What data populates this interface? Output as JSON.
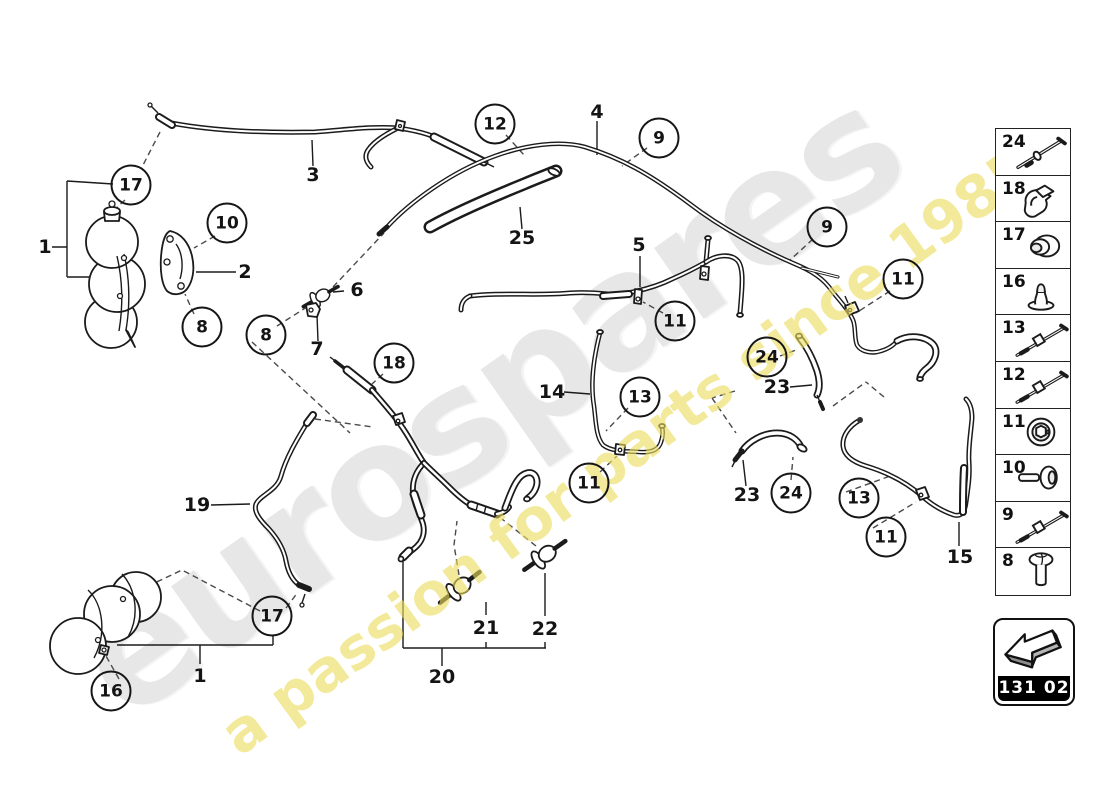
{
  "watermark": {
    "brand": "eurospares",
    "tagline": "a passion for parts since 1985",
    "brand_color": "#e7e7e7",
    "tagline_color": "#ecdc5c"
  },
  "diagram": {
    "callouts": [
      {
        "label": "1",
        "x": 45,
        "y": 247,
        "circled": false
      },
      {
        "label": "17",
        "x": 131,
        "y": 185,
        "circled": true
      },
      {
        "label": "10",
        "x": 227,
        "y": 223,
        "circled": true
      },
      {
        "label": "2",
        "x": 245,
        "y": 272,
        "circled": false
      },
      {
        "label": "8",
        "x": 202,
        "y": 327,
        "circled": true
      },
      {
        "label": "8",
        "x": 266,
        "y": 335,
        "circled": true
      },
      {
        "label": "6",
        "x": 357,
        "y": 290,
        "circled": false
      },
      {
        "label": "7",
        "x": 317,
        "y": 349,
        "circled": false
      },
      {
        "label": "3",
        "x": 313,
        "y": 175,
        "circled": false
      },
      {
        "label": "12",
        "x": 495,
        "y": 124,
        "circled": true
      },
      {
        "label": "25",
        "x": 522,
        "y": 238,
        "circled": false
      },
      {
        "label": "4",
        "x": 597,
        "y": 112,
        "circled": false
      },
      {
        "label": "9",
        "x": 659,
        "y": 138,
        "circled": true
      },
      {
        "label": "5",
        "x": 639,
        "y": 245,
        "circled": false
      },
      {
        "label": "9",
        "x": 827,
        "y": 227,
        "circled": true
      },
      {
        "label": "11",
        "x": 903,
        "y": 279,
        "circled": true
      },
      {
        "label": "11",
        "x": 675,
        "y": 321,
        "circled": true
      },
      {
        "label": "18",
        "x": 394,
        "y": 363,
        "circled": true
      },
      {
        "label": "14",
        "x": 552,
        "y": 392,
        "circled": false
      },
      {
        "label": "13",
        "x": 640,
        "y": 397,
        "circled": true
      },
      {
        "label": "24",
        "x": 767,
        "y": 357,
        "circled": true
      },
      {
        "label": "23",
        "x": 777,
        "y": 387,
        "circled": false
      },
      {
        "label": "11",
        "x": 589,
        "y": 483,
        "circled": true
      },
      {
        "label": "23",
        "x": 747,
        "y": 495,
        "circled": false
      },
      {
        "label": "24",
        "x": 791,
        "y": 493,
        "circled": true
      },
      {
        "label": "13",
        "x": 859,
        "y": 498,
        "circled": true
      },
      {
        "label": "11",
        "x": 886,
        "y": 537,
        "circled": true
      },
      {
        "label": "15",
        "x": 960,
        "y": 557,
        "circled": false
      },
      {
        "label": "19",
        "x": 197,
        "y": 505,
        "circled": false
      },
      {
        "label": "17",
        "x": 272,
        "y": 616,
        "circled": true
      },
      {
        "label": "16",
        "x": 111,
        "y": 691,
        "circled": true
      },
      {
        "label": "1",
        "x": 200,
        "y": 676,
        "circled": false
      },
      {
        "label": "21",
        "x": 486,
        "y": 628,
        "circled": false
      },
      {
        "label": "22",
        "x": 545,
        "y": 629,
        "circled": false
      },
      {
        "label": "20",
        "x": 442,
        "y": 677,
        "circled": false
      }
    ]
  },
  "legend": {
    "items": [
      {
        "number": "24",
        "icon": "long-pin"
      },
      {
        "number": "18",
        "icon": "clamp-clip"
      },
      {
        "number": "17",
        "icon": "grommet-cap"
      },
      {
        "number": "16",
        "icon": "rubber-plug"
      },
      {
        "number": "13",
        "icon": "rod-clip"
      },
      {
        "number": "12",
        "icon": "rod-clip"
      },
      {
        "number": "11",
        "icon": "round-nut"
      },
      {
        "number": "10",
        "icon": "dome-screw"
      },
      {
        "number": "9",
        "icon": "rod-clip"
      },
      {
        "number": "8",
        "icon": "pan-screw"
      }
    ],
    "code": "131 02"
  }
}
